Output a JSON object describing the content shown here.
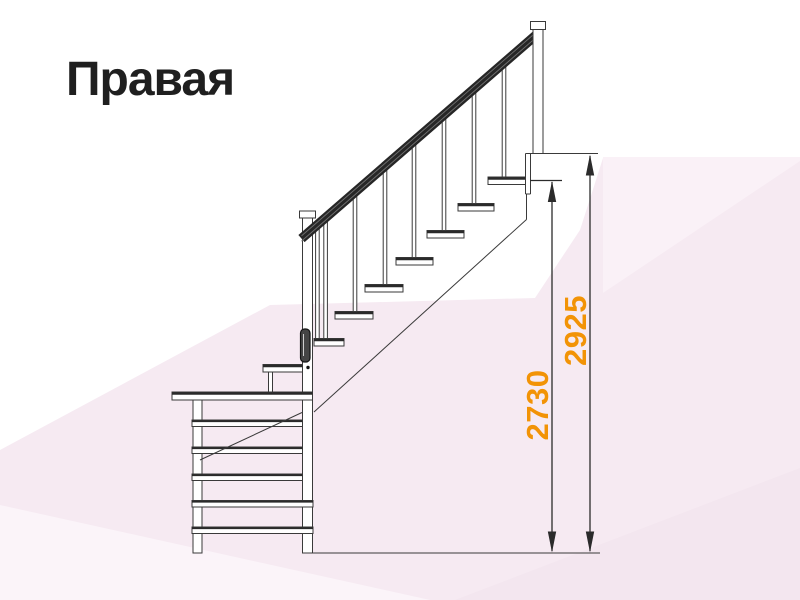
{
  "title": "Правая",
  "diagram": {
    "name": "right-turn-staircase-side-view",
    "dimension_inner": {
      "value": "2730",
      "description": "height to top step"
    },
    "dimension_outer": {
      "value": "2925",
      "description": "total height to landing"
    }
  },
  "colors": {
    "dimension_text": "#F29306",
    "drawing_line": "#3a3a3a",
    "title_text": "#1f1f1f",
    "background_tint": "#f6eaf2"
  }
}
